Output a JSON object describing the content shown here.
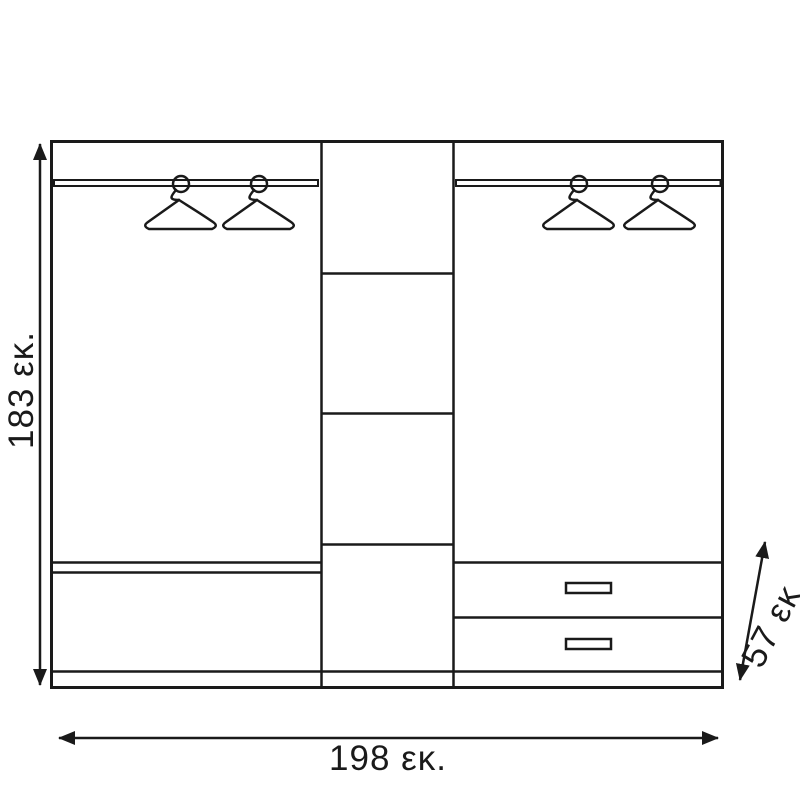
{
  "title": "Wardrobe front elevation dimension drawing",
  "labels": {
    "height": "183 εκ.",
    "width": "198 εκ.",
    "depth": "57 εκ."
  },
  "dimensions_cm": {
    "height": 183,
    "width": 198,
    "depth": 57
  },
  "colors": {
    "line": "#1a1a1a",
    "background": "#ffffff"
  },
  "components": {
    "left_section": {
      "hangers": 2,
      "clothes_rail": true,
      "bottom_shelf": true
    },
    "middle_section": {
      "shelves": 3,
      "compartments": 4
    },
    "right_section": {
      "hangers": 2,
      "clothes_rail": true,
      "drawers": 2
    },
    "plinth": true
  }
}
